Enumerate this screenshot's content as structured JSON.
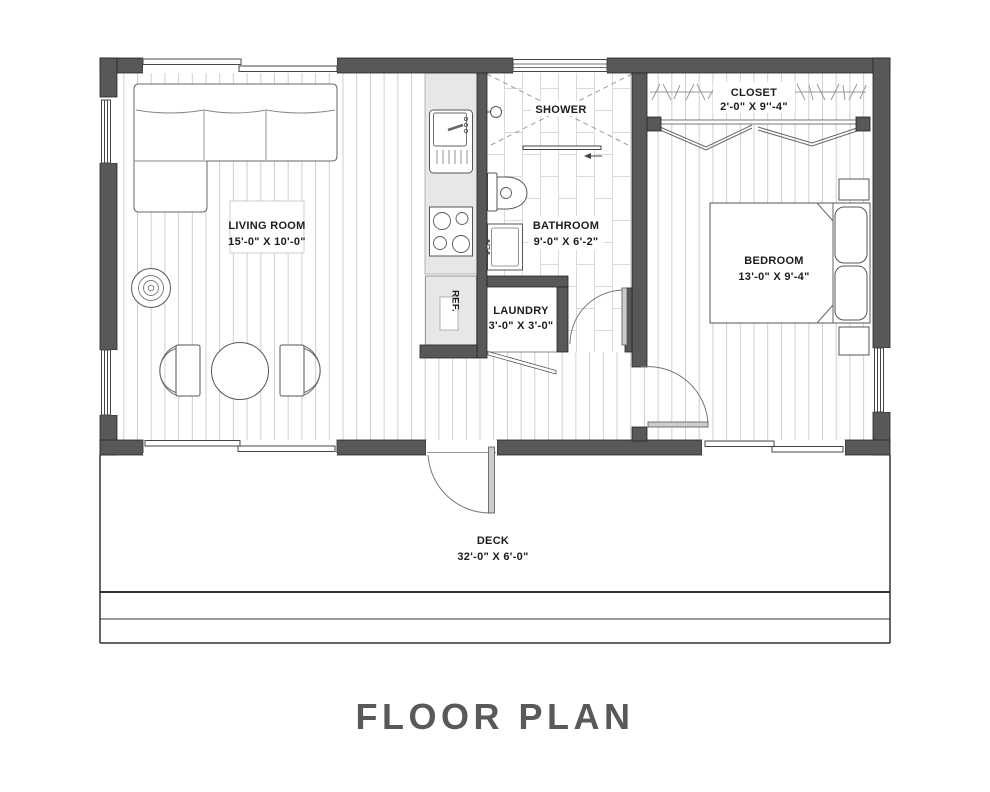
{
  "title": "FLOOR PLAN",
  "rooms": {
    "living_room": {
      "name": "LIVING ROOM",
      "dims": "15'-0\" X 10'-0\""
    },
    "kitchen": {
      "ref_label": "REF."
    },
    "shower": {
      "name": "SHOWER"
    },
    "bathroom": {
      "name": "BATHROOM",
      "dims": "9'-0\" X 6'-2\""
    },
    "laundry": {
      "name": "LAUNDRY",
      "dims": "3'-0\" X 3'-0\""
    },
    "closet": {
      "name": "CLOSET",
      "dims": "2'-0\" X 9''-4\""
    },
    "bedroom": {
      "name": "BEDROOM",
      "dims": "13'-0\" X 9'-4\""
    },
    "deck": {
      "name": "DECK",
      "dims": "32'-0\" X 6'-0\""
    }
  },
  "colors": {
    "wall": "#57585a",
    "counter": "#e7e7e7",
    "floor_line": "#cfcfcf",
    "tile_line": "#dadada",
    "title": "#58595b",
    "text": "#1c1c1c"
  }
}
